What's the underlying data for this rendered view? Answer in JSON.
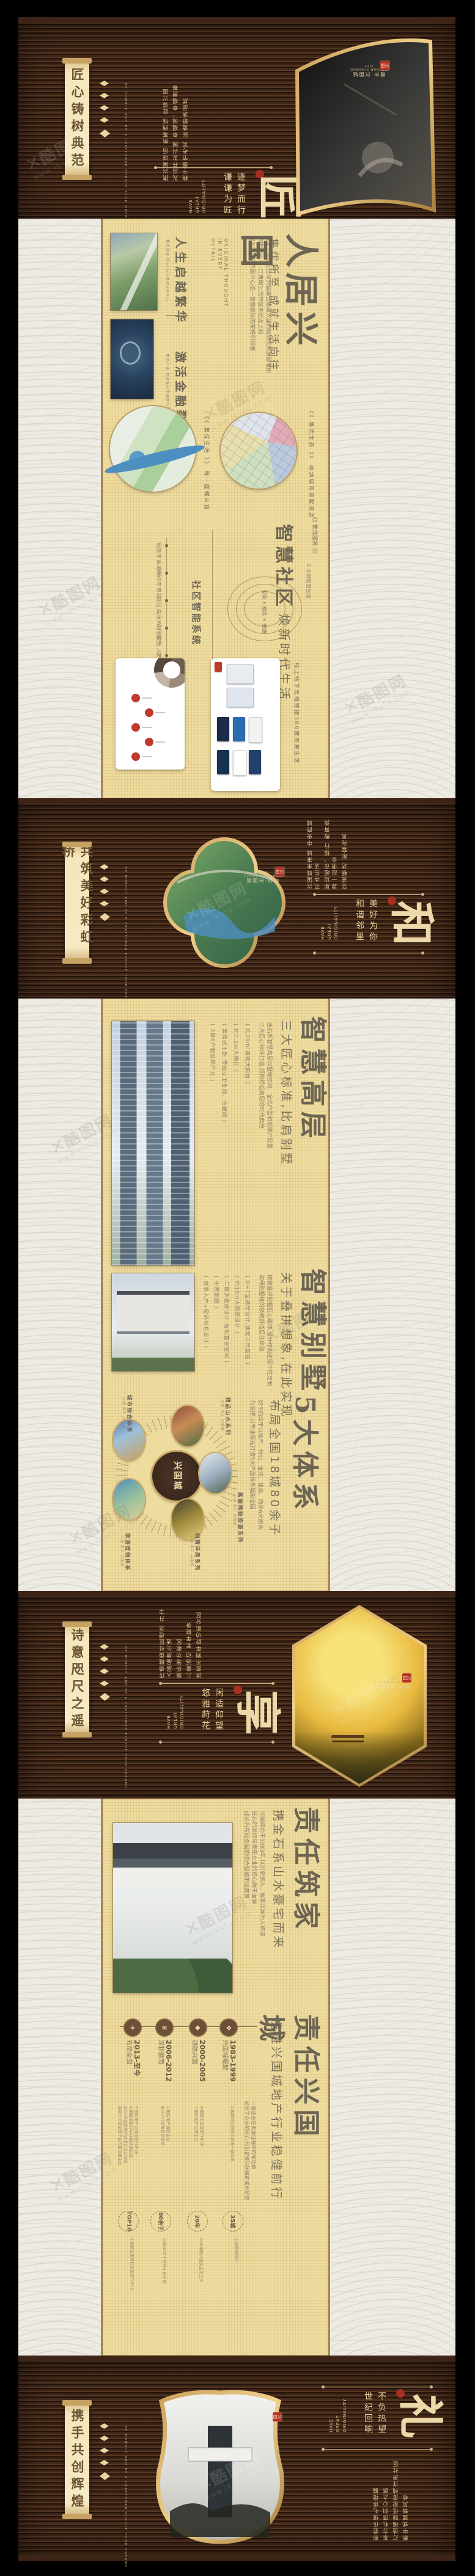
{
  "brand": {
    "city": "赣州·兴国城",
    "en": "GANNAN XINGGUO CITY",
    "seal": "兴国",
    "slogan": [
      "HAVE",
      "GREAT",
      "ORIGINALITY"
    ],
    "scroll_en": "BE HUMBLE AND BE A CRAFTSMAN PURSUE YOUR DREAMS"
  },
  "watermark": {
    "mark": "✕",
    "site": "酷图网",
    "url": "www.ikutu.com"
  },
  "band_jiang": {
    "scroll": "匠心铸树典范",
    "cols": [
      "携兴国城后 执笔西城 匠造兴国",
      "先后开发兴国 幸福城、幸福居等",
      "精于细节考究 匠造舒适品质"
    ],
    "phrases": [
      "逐梦而行",
      "谦谦为匠"
    ],
    "big": "匠"
  },
  "beige_renju": {
    "cap1": {
      "title": "人生启越繁华",
      "tiny": "集优商业 约50万方体验式MALL"
    },
    "cap2": {
      "title": "激活金融裂变",
      "tiny": "集优产业 缔造城市金融新引擎"
    },
    "en": "ORIGINAL THOUGHT\nIN EVERY\nDETAIL",
    "body": "赣南兴国城生活与兴国黄金地段人居的独特优势脱颖而出\n点睛兴国——江两岸生活带这条巨龙之眼\n成为兴国城市副中心这一首席板块的荣耀引领者",
    "subtitle": "集优所至 成就生活向往",
    "title": "人居兴国",
    "map1_note": "《《 集优生活 》》  每一面都从容",
    "map2_note": "《《 集优生态 》》  收纳城市禀赋资源",
    "community": {
      "bracket": "《《 集优服务 》》",
      "tag": "① 引领智慧生活",
      "title": "智慧社区",
      "subtitle": "焕新时代生活",
      "circle": "电商 × 服务 × 金融",
      "sys": "社区智能系统",
      "items": [
        "智能车库道闸",
        "移动充电站",
        "社区高速WIFI覆盖",
        "社区交互入户终端",
        "社区智能消费"
      ],
      "caption": "线上线下无缝链接360度完美生活"
    }
  },
  "band_he": {
    "scroll": "共筑美好彩虹桥",
    "cols": [
      "兴国城未来城 中央商城范本生活",
      "周边超市、银行 教育资源一应俱全",
      "交通畅达 配套完善"
    ],
    "phrases": [
      "美好为你",
      "和谐邻里"
    ],
    "big": "和"
  },
  "beige_smart": {
    "high": {
      "title": "智慧高层",
      "subtitle": "三大匠心标准,比肩别墅",
      "body": "金石系智慧高层以墅级空间、全优户型和低梯户配置\n三大匠心标准打造,领衔舒适高层的时代典范",
      "bullets": [
        "( 约20m²景观大阳台 )",
        "( 约7.2m大横厅 )",
        "( 套房式主卧,带独立卫生间、衣帽间 )",
        "( 3梯6户超低梯户比 )"
      ]
    },
    "villa": {
      "title": "智慧别墅",
      "subtitle": "关于叠拼想象,在此实现",
      "body": "精装叠拼别墅匠心雕琢,设计结构还原个性定制\n演绎别墅级的极致舒适居住体验",
      "bullets": [
        "( U+T全通厅设计,满足三代居住 )",
        "( 约10m大面宽设计 )",
        "( 二楼多套房设计,智配露台空间 )",
        "( 中西双厨 )",
        "( 首层入户+密码权控设计 )"
      ]
    },
    "five": {
      "title": "5大体系",
      "subtitle": "布局全国18城80余子",
      "body": "如今的华宇以地产、物业、金控、建设、海外6大板块\n为支撑,以专业眼光打造5大产品体系辐射全国",
      "center": "兴国城",
      "labels": [
        "城市综合体系",
        "精品山水系列",
        "高端稀缺资源系列",
        "创新洋房系列",
        "旅游度假体系"
      ],
      "label_sub": "兴国 滨江 兴国城"
    }
  },
  "band_xiang": {
    "scroll": "诗意咫尺之遥",
    "cols": [
      "传递健康社区理念 升华人居品质生活",
      "娱乐等功能区",
      "儿童活动 老年健身",
      "适应不同年龄功能分区"
    ],
    "phrases": [
      "闲适仰望",
      "悠雅莳花"
    ],
    "big": "享"
  },
  "beige_zeren": {
    "home": {
      "title": "责任筑家",
      "subtitle": "携金石系山水豪宅而来",
      "body": "兴国城始于1983年,以历史悠久、根基深厚为人称道\n匠心的坚持与责任立业的初心融于血脉\n成长为布局全国的综合型城市运营商"
    },
    "intro": "一家企业在发展征程中的军功章\n彰显了企业的匠心,也见证着兴国城的成长足迹",
    "timeline": [
      {
        "years": "2013-至今",
        "label": "布局全国",
        "icon": "✈",
        "sub": "中国房地产品牌价值TOP20\n中国建设银行AAA级信用企业\n2017中国房地产开发企业100强\n连续七年获全国守合同重信用企业"
      },
      {
        "years": "2006-2012",
        "label": "深耕赣南",
        "icon": "♛",
        "sub": "中国房地产诚信企业\n金沙时代获鲁班奖金奖"
      },
      {
        "years": "2000-2005",
        "label": "领航兴国",
        "icon": "◆",
        "sub": "中国城市运营商TOP50\n中国房地产品牌企业"
      },
      {
        "years": "1983-1999",
        "label": "兴国城崛起",
        "icon": "❖",
        "sub": "兴国城物业获物业管理一级资质"
      }
    ],
    "city": {
      "title": "责任兴国城",
      "subtitle": "携进兴国城地产行业稳健前行",
      "stats": [
        {
          "num": "TOP10",
          "sub": "中国物业服务社区运营TOP10"
        },
        {
          "num": "80余子",
          "sub": "18城80余个项目布局全国"
        },
        {
          "num": "20年",
          "sub": "20年蝉联兴国房企前三甲"
        },
        {
          "num": "35城",
          "sub": "35城稳健前行"
        }
      ]
    }
  },
  "band_li": {
    "scroll": "携手共创辉煌",
    "cols": [
      "彰显传统礼序精髓",
      "东方礼序归心之旅",
      "打造稀缺低密度纯洋房社区",
      "新中式建筑风格"
    ],
    "phrases": [
      "不负热望",
      "世纪回响"
    ],
    "big": "礼"
  }
}
